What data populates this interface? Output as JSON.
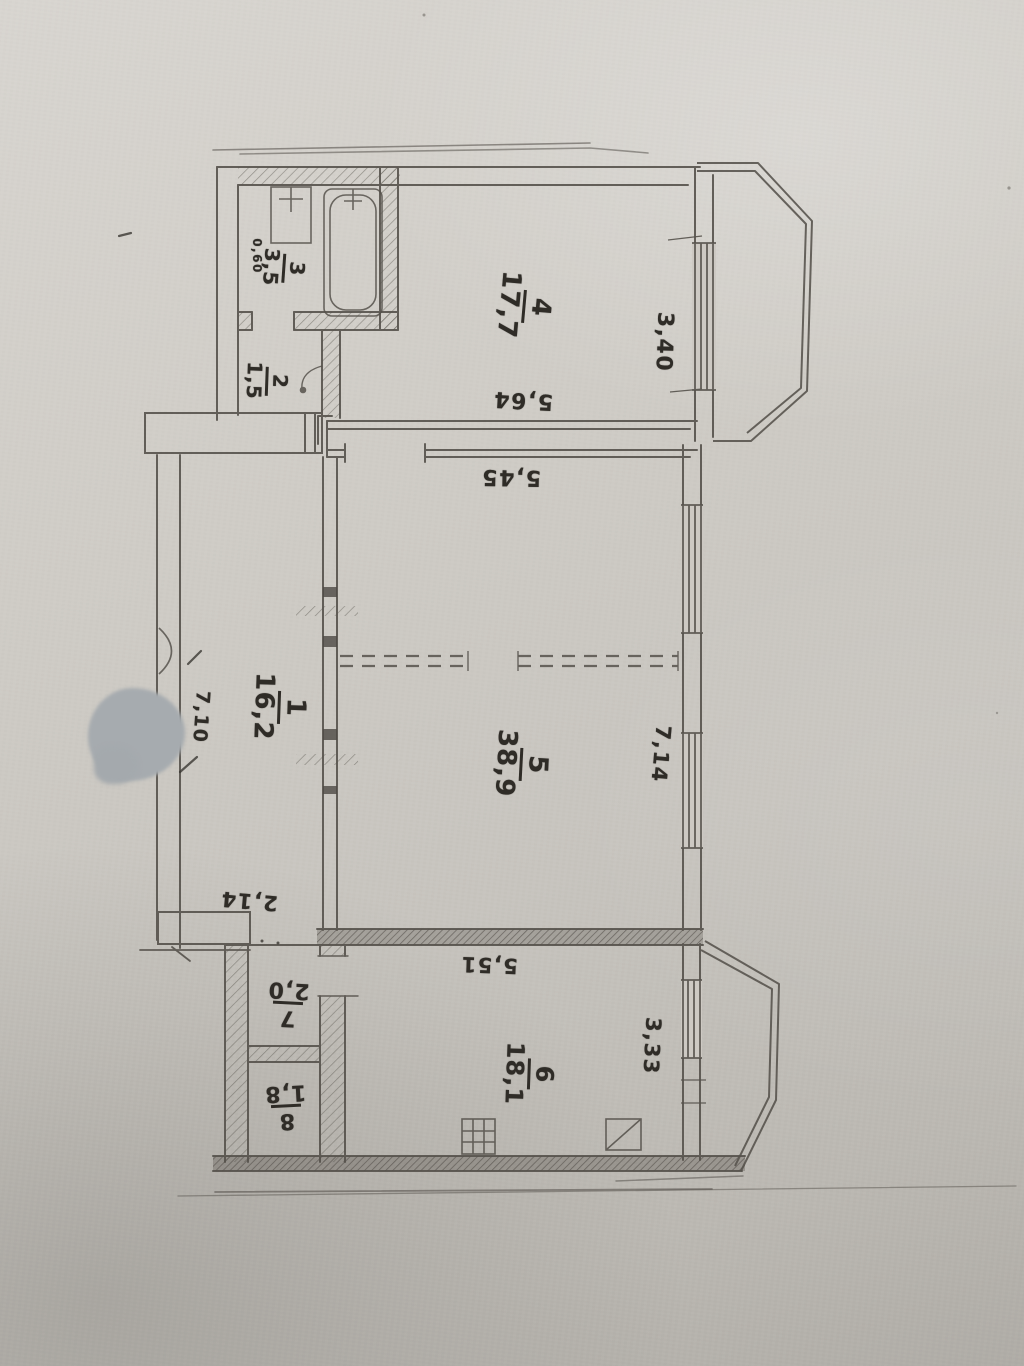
{
  "plan": {
    "rooms": {
      "r1": {
        "number": "1",
        "area": "16,2"
      },
      "r2": {
        "number": "2",
        "area": "1,5"
      },
      "r3": {
        "number": "3",
        "area": "3,5"
      },
      "r4": {
        "number": "4",
        "area": "17,7"
      },
      "r5": {
        "number": "5",
        "area": "38,9"
      },
      "r6": {
        "number": "6",
        "area": "18,1"
      },
      "r7": {
        "number": "7",
        "area": "2,0"
      },
      "r8": {
        "number": "8",
        "area": "1,8"
      }
    },
    "dims": {
      "d060": "0,60",
      "d564": "5,64",
      "d340": "3,40",
      "d545": "5,45",
      "d710": "7,10",
      "d714": "7,14",
      "d214": "2,14",
      "d551": "5,51",
      "d333": "3,33"
    },
    "colors": {
      "paper": "#cdc9c3",
      "graphite": "#56524c",
      "ink": "#2f2c27",
      "blob": "#a6abaf"
    }
  }
}
